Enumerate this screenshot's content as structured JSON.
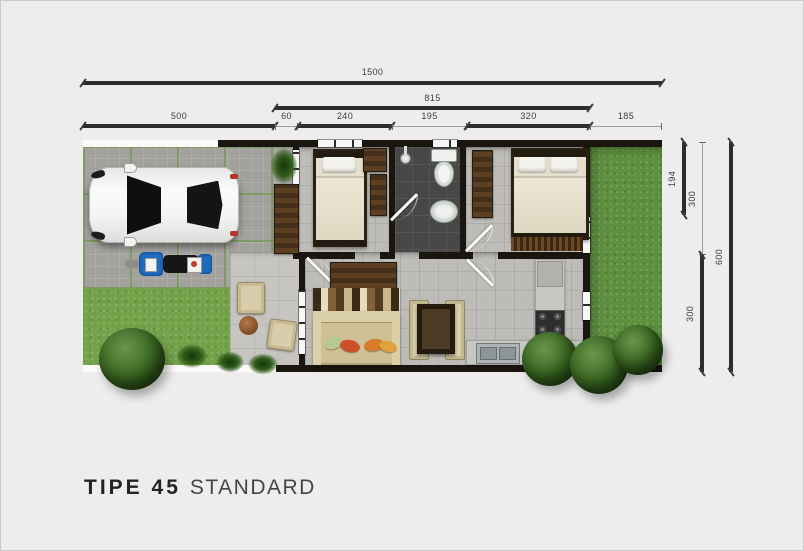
{
  "title": {
    "model": "TIPE 45",
    "variant": "STANDARD"
  },
  "dimensions": {
    "top": {
      "total": "1500",
      "house": "815",
      "segments": [
        {
          "label": "500"
        },
        {
          "label": "60"
        },
        {
          "label": "240"
        },
        {
          "label": "195"
        },
        {
          "label": "320"
        },
        {
          "label": "185"
        }
      ]
    },
    "right": {
      "bedroom_depth": "194",
      "upper_half": "300",
      "lower_half": "300",
      "total": "600"
    }
  },
  "colors": {
    "background": "#ededed",
    "dimension_line": "#2f2c29",
    "wall": "#1b1510",
    "driveway": "#a2a19d",
    "grass_front": "#74a24a",
    "grass_back": "#5d8f3e",
    "floor_tile": "#bdbcb8",
    "bathroom_floor": "#474747",
    "wood": "#5d3f22",
    "sofa": "#cfc096",
    "car_body": "#f5f5f3",
    "motorcycle": "#1f6bbf"
  }
}
